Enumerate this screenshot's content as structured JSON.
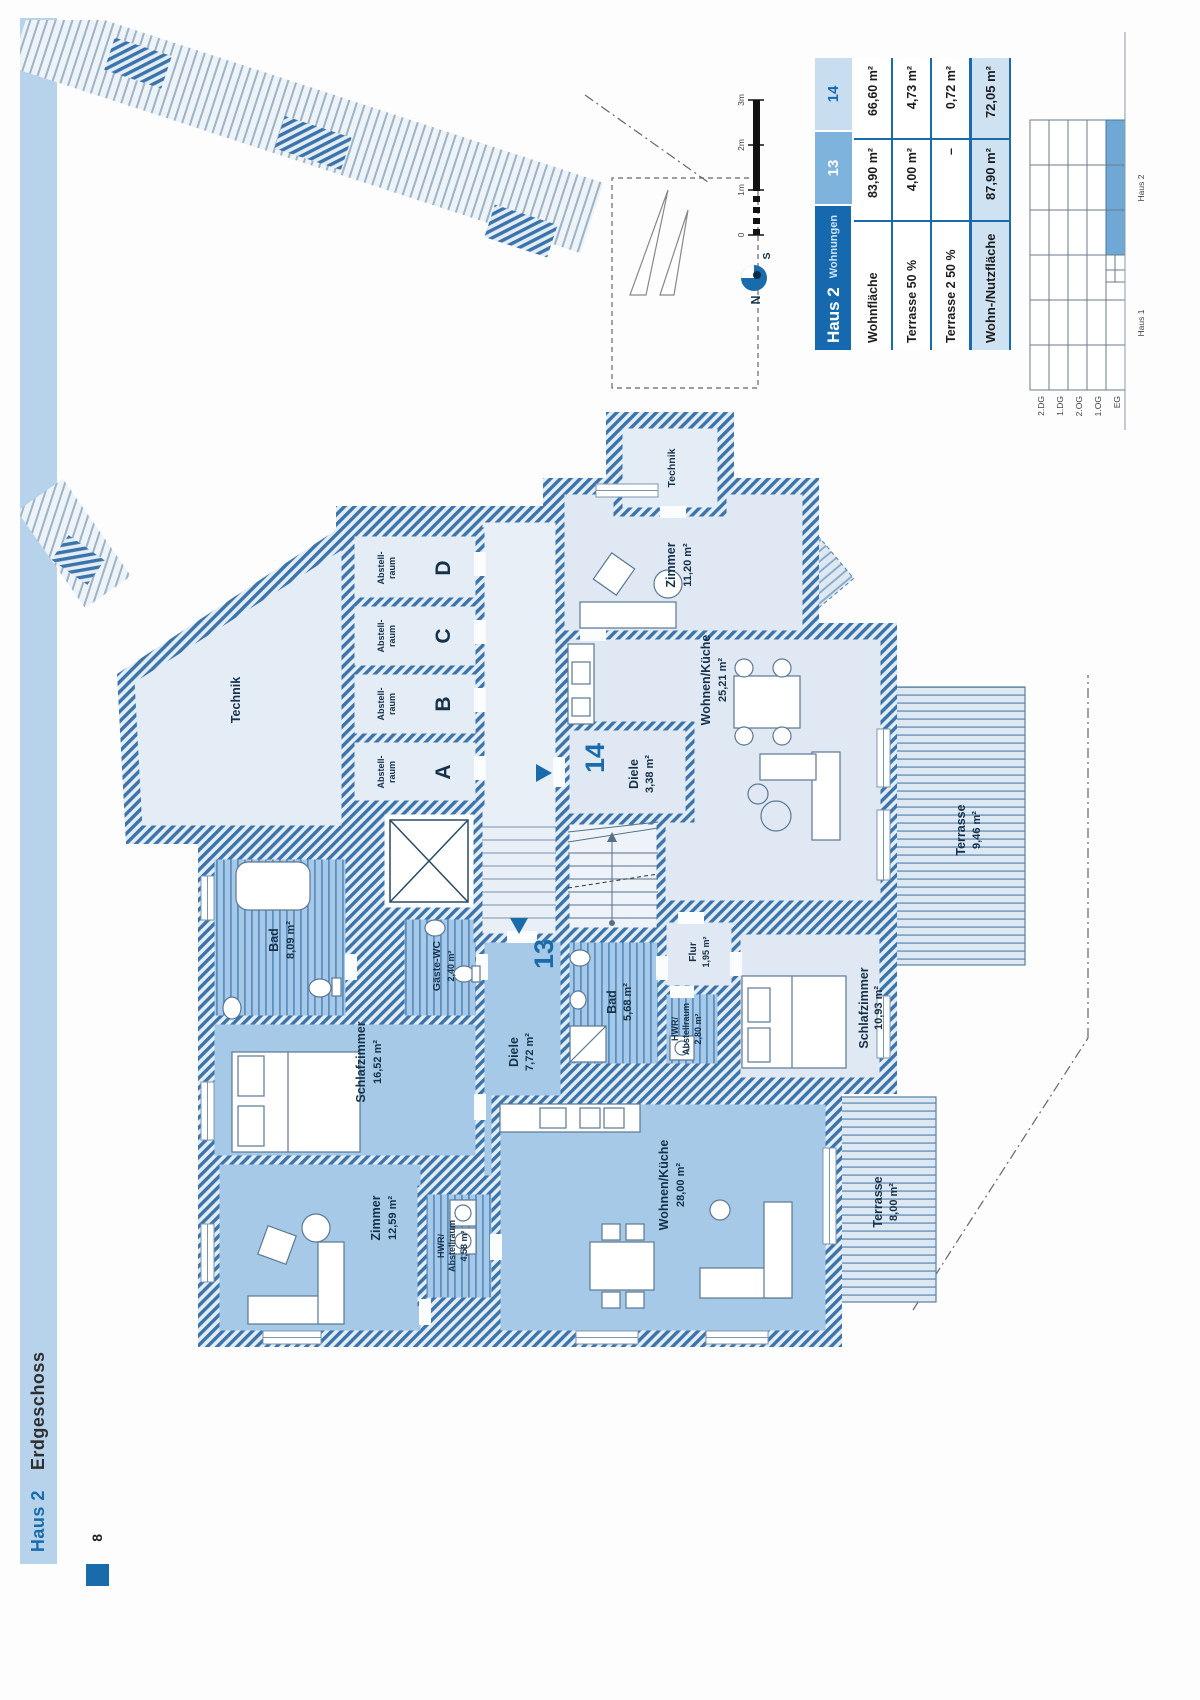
{
  "sidebar": {
    "haus": "Haus 2",
    "floor": "Erdgeschoss"
  },
  "page_number": "8",
  "compass": {
    "n": "N",
    "s": "S"
  },
  "scalebar": {
    "t0": "0",
    "t1": "1m",
    "t2": "2m",
    "t3": "3m"
  },
  "table": {
    "title": "Haus 2",
    "subtitle": "Wohnungen",
    "col13": "13",
    "col14": "14",
    "rows": [
      {
        "label": "Wohnfläche",
        "v13": "83,90 m²",
        "v14": "66,60 m²"
      },
      {
        "label": "Terrasse 50 %",
        "v13": "4,00 m²",
        "v14": "4,73 m²"
      },
      {
        "label": "Terrasse 2 50 %",
        "v13": "–",
        "v14": "0,72 m²"
      },
      {
        "label": "Wohn-/Nutzfläche",
        "v13": "87,90 m²",
        "v14": "72,05 m²"
      }
    ]
  },
  "keyplan": {
    "floors": [
      "2.DG",
      "1.DG",
      "2.OG",
      "1.OG",
      "EG"
    ],
    "house1": "Haus 1",
    "house2": "Haus 2"
  },
  "common": {
    "technik": "Technik",
    "technik2": "Technik",
    "storage_line1": "Abstell-",
    "storage_line2": "raum",
    "storage_units": [
      "A",
      "B",
      "C",
      "D"
    ]
  },
  "apt13": {
    "number": "13",
    "bad": {
      "name": "Bad",
      "area": "8,09 m²"
    },
    "gaeste_wc": {
      "name": "Gäste-WC",
      "area": "2,40 m²"
    },
    "schlafzimmer": {
      "name": "Schlafzimmer",
      "area": "16,52 m²"
    },
    "diele": {
      "name": "Diele",
      "area": "7,72 m²"
    },
    "zimmer": {
      "name": "Zimmer",
      "area": "12,59 m²"
    },
    "hwr": {
      "l1": "HWR/",
      "l2": "Abstellraum",
      "area": "4,58 m²"
    },
    "wohnen": {
      "name": "Wohnen/Küche",
      "area": "28,00 m²"
    },
    "terrasse": {
      "name": "Terrasse",
      "area": "8,00 m²"
    }
  },
  "apt14": {
    "number": "14",
    "zimmer": {
      "name": "Zimmer",
      "area": "11,20 m²"
    },
    "wohnen": {
      "name": "Wohnen/Küche",
      "area": "25,21 m²"
    },
    "diele": {
      "name": "Diele",
      "area": "3,38 m²"
    },
    "bad": {
      "name": "Bad",
      "area": "5,68 m²"
    },
    "flur": {
      "name": "Flur",
      "area": "1,95 m²"
    },
    "hwr": {
      "l1": "HWR/",
      "l2": "Abstellraum",
      "area": "2,80 m²"
    },
    "schlafzimmer": {
      "name": "Schlafzimmer",
      "area": "10,93 m²"
    },
    "terrasse": {
      "name": "Terrasse",
      "area": "9,46 m²"
    },
    "terrasse2": {
      "name": "Terrasse 2",
      "area": "1,44 m²"
    }
  },
  "colors": {
    "accent": "#1a6bab",
    "apartment13_fill": "#a6c9e8",
    "apartment14_fill": "#dfe8f3",
    "wall_hatch": "#3c74aa",
    "sidebar_bar": "#b7d3eb"
  }
}
